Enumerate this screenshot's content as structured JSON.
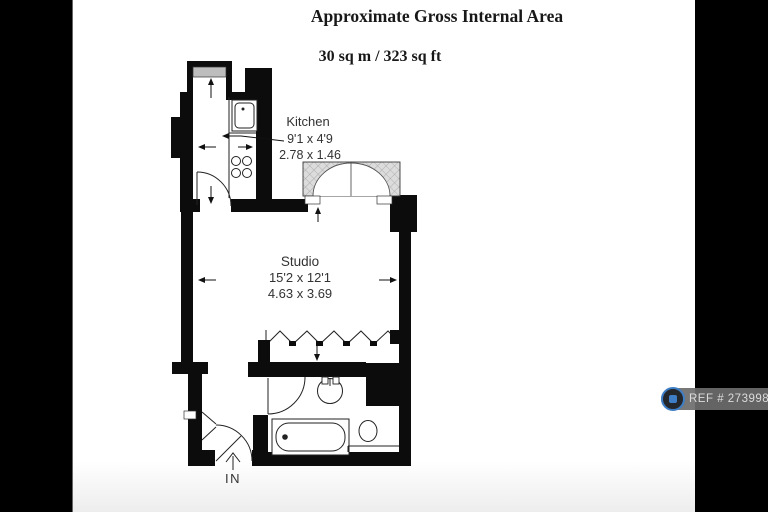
{
  "header": {
    "title": "Approximate Gross Internal Area",
    "area": "30 sq m / 323 sq ft"
  },
  "floorplan": {
    "kitchen": {
      "label": "Kitchen",
      "dim_imperial": "9'1 x 4'9",
      "dim_metric": "2.78 x 1.46"
    },
    "studio": {
      "label": "Studio",
      "dim_imperial": "15'2 x 12'1",
      "dim_metric": "4.63 x 3.69"
    },
    "entrance": {
      "label": "IN"
    },
    "fixtures": [
      "bay-window",
      "kitchen-sink",
      "hob",
      "french-doors-balcony",
      "folding-doors",
      "closet",
      "wash-basin",
      "bathtub",
      "toilet"
    ],
    "wall_color": "#0c0c0c",
    "hatch_color": "#dcdcdc"
  },
  "ref_badge": {
    "label": "REF # 2739980",
    "icon": "camera-icon",
    "bg_color": "#6c6c6c",
    "text_color": "#dcdcdc",
    "icon_accent": "#3e7ec6"
  },
  "photo": {
    "background": "#ffffff",
    "letterbox_color": "#000000"
  }
}
